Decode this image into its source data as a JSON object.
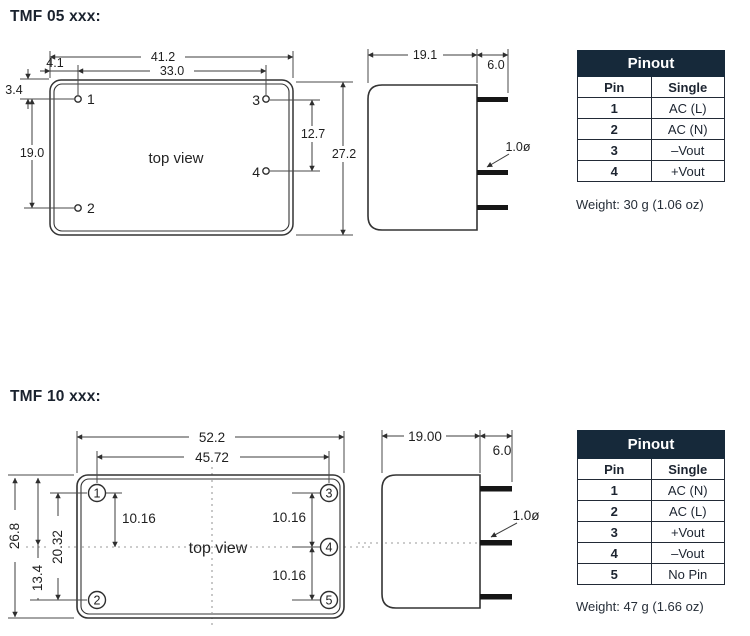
{
  "tmf05": {
    "title": "TMF 05 xxx:",
    "top_view": {
      "label": "top view",
      "pins": [
        "1",
        "2",
        "3",
        "4"
      ],
      "dims": {
        "body_width": "41.2",
        "pin_span_x": "33.0",
        "pin_offset_x": "4.1",
        "pin_offset_y": "3.4",
        "pin_span_y_left": "19.0",
        "pin_span_y_right": "12.7",
        "body_height": "27.2"
      }
    },
    "side_view": {
      "dims": {
        "body_depth": "19.1",
        "pin_length": "6.0",
        "pin_diameter": "1.0ø"
      }
    },
    "pinout": {
      "title": "Pinout",
      "columns": [
        "Pin",
        "Single"
      ],
      "rows": [
        [
          "1",
          "AC (L)"
        ],
        [
          "2",
          "AC (N)"
        ],
        [
          "3",
          "–Vout"
        ],
        [
          "4",
          "+Vout"
        ]
      ]
    },
    "weight": "Weight: 30 g (1.06 oz)"
  },
  "tmf10": {
    "title": "TMF 10 xxx:",
    "top_view": {
      "label": "top view",
      "pins": [
        "1",
        "2",
        "3",
        "4",
        "5"
      ],
      "dims": {
        "body_width": "52.2",
        "pin_span_x": "45.72",
        "body_height": "26.8",
        "pin_span_y": "20.32",
        "half_height": "13.4",
        "pin_pitch_left": "10.16",
        "pin_pitch_top": "10.16",
        "pin_pitch_bottom": "10.16"
      }
    },
    "side_view": {
      "dims": {
        "body_depth": "19.00",
        "pin_length": "6.0",
        "pin_diameter": "1.0ø"
      }
    },
    "pinout": {
      "title": "Pinout",
      "columns": [
        "Pin",
        "Single"
      ],
      "rows": [
        [
          "1",
          "AC (N)"
        ],
        [
          "2",
          "AC (L)"
        ],
        [
          "3",
          "+Vout"
        ],
        [
          "4",
          "–Vout"
        ],
        [
          "5",
          "No Pin"
        ]
      ]
    },
    "weight": "Weight: 47 g (1.66 oz)"
  }
}
